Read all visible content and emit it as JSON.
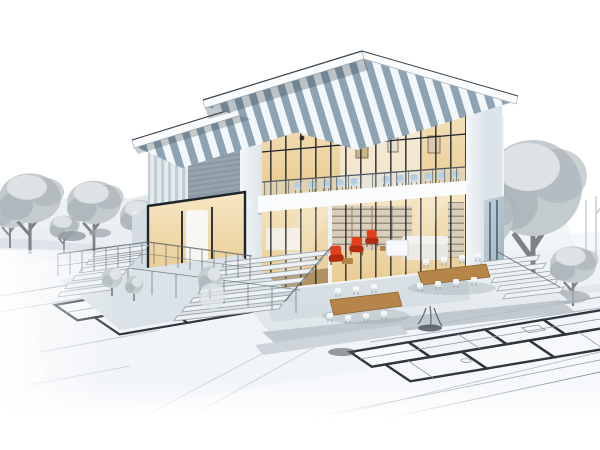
{
  "scene": {
    "title": "Architectural concept rendering of a modern house",
    "description": "Modern two-storey flat-roof glass house rendered in full colour, emerging from monochrome 2D blueprint floor plans; grey winter trees left and right, tiered concrete terraces with wire fences and stairs, outdoor patio with wooden dining tables and white chairs, upper balcony with pale blue chairs, living room with bright red armchairs and bookshelf, warm-lit kitchen and bedroom wing",
    "style": "photorealistic 3D visualisation blended into construction blueprint drawings",
    "regions": {
      "background": "white sky, pale grey hills and leafy grey trees",
      "left": "row of grey trees and curved road on monochrome ground",
      "center": "full-colour house with overhanging striped-soffit roofs",
      "right": "large grey trees, bare saplings and shrub hedge",
      "foreground": "blueprint floor plans with thick black walls and thin dimension lines fading to white"
    }
  },
  "palette": {
    "paper": "#ffffff",
    "bp-paper": "#eef3f7",
    "bp-line": "#8f9aa4",
    "bp-wall": "#2f363d",
    "wash": "#e9eef2",
    "road": "#dde3e8",
    "tree-light": "#e0e6e9",
    "tree-mid": "#c3cbcf",
    "tree-dark": "#aab3b8",
    "trunk": "#7c8287",
    "roof-white": "#f3f7f9",
    "roof-slate": "#8ea2b2",
    "fascia": "#fafcfd",
    "fascia-edge": "#3a424a",
    "shadow": "#2e3840",
    "mullion": "#1d242b",
    "glass-cool": "#c4d3dd",
    "glass-warm1": "#e8c98e",
    "glass-warm2": "#f6e7c4",
    "interior-deep": "#8a6a3f",
    "curtain": "#f8f9fa",
    "slat-light": "#e4eaee",
    "slat-mid": "#c2cdd4",
    "metal-a": "#97a5af",
    "metal-b": "#8b98a2",
    "white-col": "#f4f7f9",
    "col-shade": "#dde4e9",
    "concrete-a": "#eef2f4",
    "concrete-b": "#dbe3e8",
    "concrete-c": "#c6d0d6",
    "concrete-edge": "#9aa6ad",
    "red": "#e2401c",
    "red-dark": "#b22d10",
    "blue-chair": "#a9c6da",
    "wood": "#b5854a",
    "wood-dark": "#86613a",
    "shelf-bg": "#d9cdbc",
    "shelf-line": "#8d7f6c",
    "sofa": "#e9e7e2",
    "plant-dark": "#49525a",
    "fence": "#5c646b"
  }
}
